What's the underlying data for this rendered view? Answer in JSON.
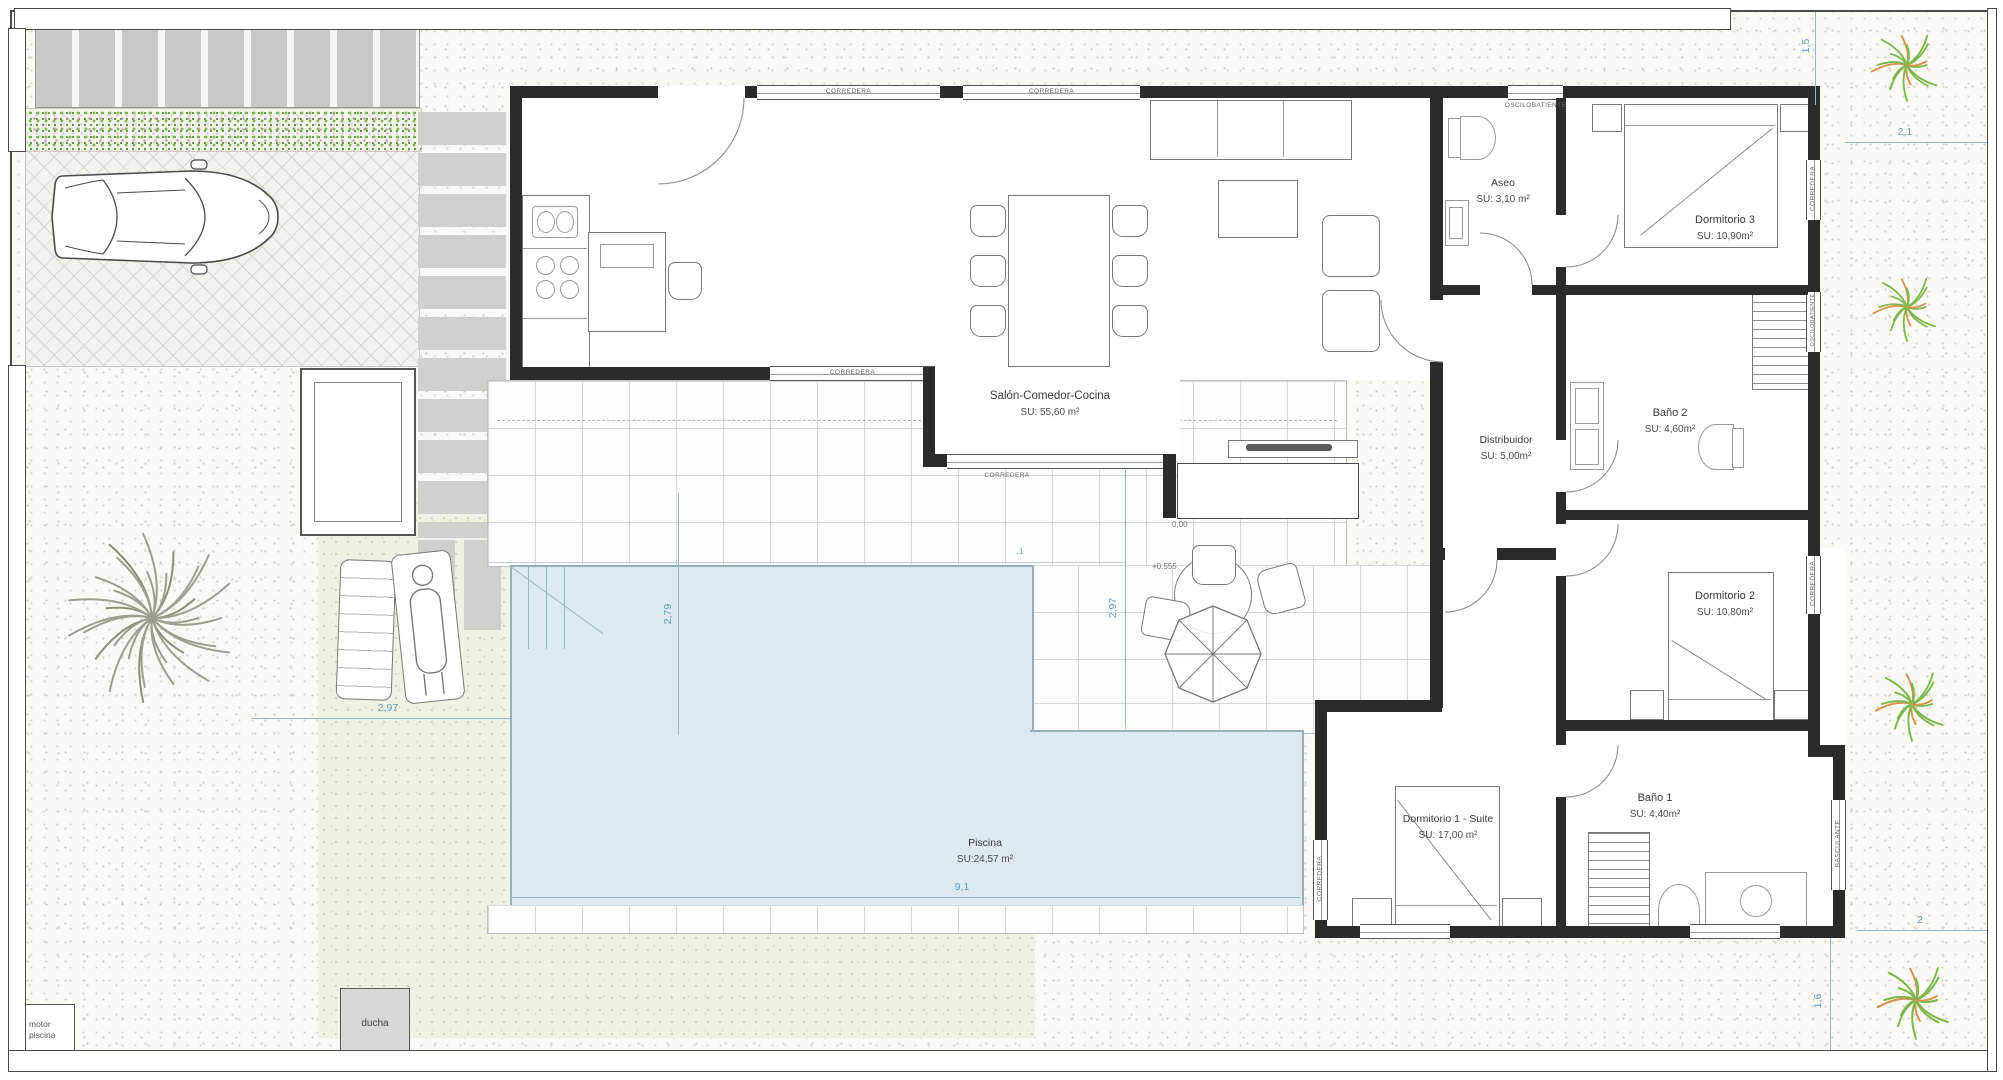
{
  "rooms": {
    "salon": {
      "name": "Salón-Comedor-Cocina",
      "area": "SU: 55,60 m²"
    },
    "aseo": {
      "name": "Aseo",
      "area": "SU: 3,10 m²"
    },
    "dormitorio3": {
      "name": "Dormitorio 3",
      "area": "SU: 10,90m²"
    },
    "bano2": {
      "name": "Baño 2",
      "area": "SU: 4,60m²"
    },
    "distribuidor": {
      "name": "Distribuidor",
      "area": "SU: 5,00m²"
    },
    "dormitorio2": {
      "name": "Dormitorio 2",
      "area": "SU: 10,80m²"
    },
    "dormitorio1": {
      "name": "Dormitorio 1 - Suite",
      "area": "SU: 17,00 m²"
    },
    "bano1": {
      "name": "Baño 1",
      "area": "SU: 4,40m²"
    },
    "piscina": {
      "name": "Piscina",
      "area": "SU:24,57 m²"
    }
  },
  "outdoor": {
    "motor_line1": "motor",
    "motor_line2": "piscina",
    "ducha": "ducha"
  },
  "windows": {
    "corredera": "CORREDERA",
    "oscilobatiente": "OSCILOBATIENTE",
    "basculante": "BASCULANTE"
  },
  "dimensions": {
    "top_right_v": "1,5",
    "top_right_h": "2,1",
    "bottom_right_h": "2",
    "bottom_right_v": "1,6",
    "terrace_left_v": "2,79",
    "terrace_mid_v": "2,97",
    "lawn_h": "2,97",
    "pool_w": "9,1",
    "pool_top": ",1"
  },
  "levels": {
    "terrace": "0,00",
    "interior": "+0.555"
  },
  "colors": {
    "dimension": "#5f9cc8",
    "pool": "#dde9f0",
    "lawn": "#eff1e3",
    "plant_green": "#7cb84c",
    "plant_orange": "#d9924e",
    "wall": "#2b2b2b"
  }
}
